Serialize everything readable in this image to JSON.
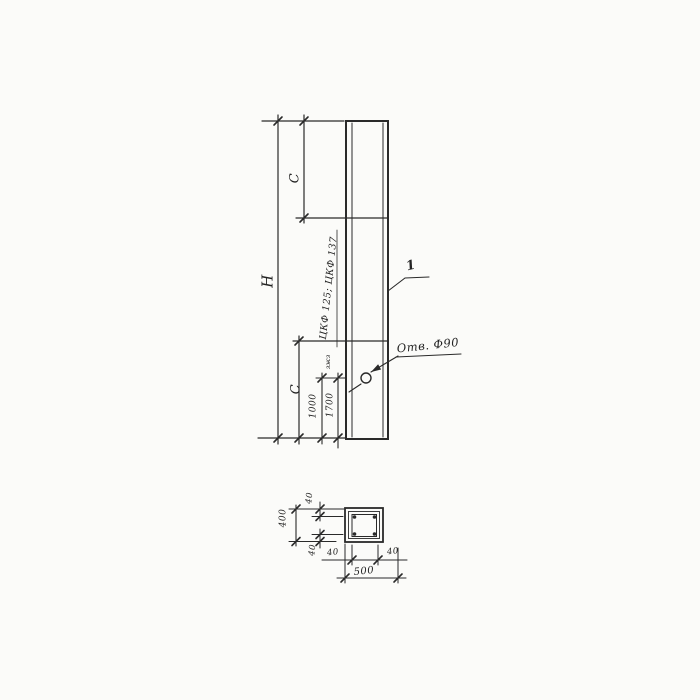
{
  "drawing": {
    "paper_color": "#fbfbf9",
    "ink_color": "#232323",
    "elevation": {
      "height_label": "Н",
      "segment_top_label": "С",
      "segment_bottom_label": "С",
      "mark_label": "ЦКФ 125; ЦКФ 137",
      "mark_note": "зжз",
      "dim_to_hole": "1000",
      "dim_to_line": "1700",
      "hole_callout": "Отв. Ф90",
      "item_number": "1"
    },
    "section": {
      "overall_width": "500",
      "overall_height": "400",
      "cover_top": "40",
      "cover_bottom": "40",
      "cover_left": "40",
      "cover_right": "40"
    }
  }
}
